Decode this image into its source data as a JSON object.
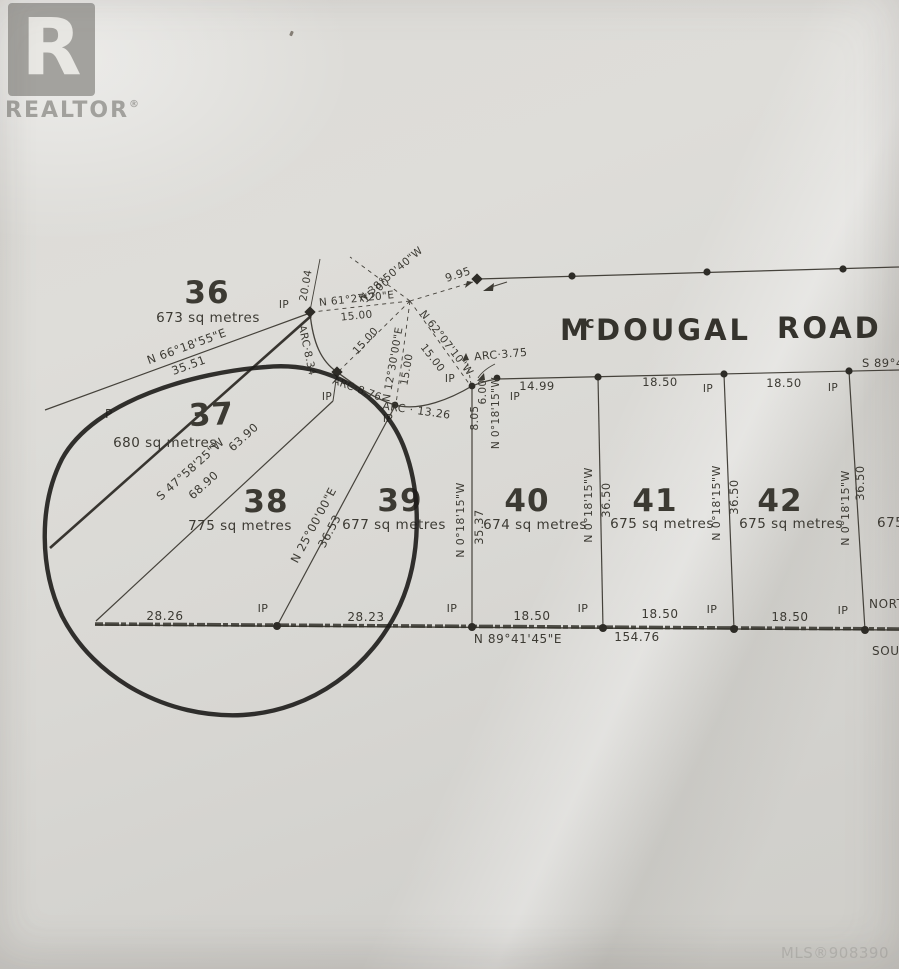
{
  "branding": {
    "logo_letter": "R",
    "logo_text": "REALTOR",
    "registered": "®"
  },
  "watermark": {
    "mls": "MLS®908390"
  },
  "road": {
    "m": "M",
    "c": "c",
    "dougal": "DOUGAL",
    "road_word": "ROAD"
  },
  "marks": {
    "ip": "IP",
    "post": "P"
  },
  "dims": {
    "d15": "15.00",
    "d1850": "18.50",
    "d1499": "14.99",
    "d2826": "28.26",
    "d2823": "28.23",
    "d3551": "35.51",
    "d3537": "35.37",
    "d3650": "36.50",
    "d3653": "36.53",
    "d6390": "63.90",
    "d6890": "68.90",
    "d995": "9.95",
    "d2004": "20.04",
    "d600": "6.00",
    "d805": "8.05",
    "d15476": "154.76"
  },
  "bearings": {
    "ns": "N 0°18'15\"W",
    "lot36_line": "N 66°18'55\"E",
    "lot37_line": "S 47°58'25\"W",
    "lot38_line": "N 25°00'00\"E",
    "south_line": "N 89°41'45\"E",
    "spoke_e": "N 61°27'20\"E",
    "spoke_nw": "N 38°50'40\"W",
    "spoke_mid": "N 12°30'00\"E",
    "spoke_se": "N 62°07'10\"W",
    "edge_clip": "S 89°4"
  },
  "arcs": {
    "a834": "ARC·8.34",
    "a876": "ARC·8.76",
    "a1326": "ARC · 13.26",
    "a375": "ARC·3.75"
  },
  "lots": {
    "l36": {
      "num": "36",
      "area": "673 sq metres"
    },
    "l37": {
      "num": "37",
      "area": "680 sq metres"
    },
    "l38": {
      "num": "38",
      "area": "775 sq metres"
    },
    "l39": {
      "num": "39",
      "area": "677 sq metres"
    },
    "l40": {
      "num": "40",
      "area": "674 sq metres"
    },
    "l41": {
      "num": "41",
      "area": "675 sq metres"
    },
    "l42": {
      "num": "42",
      "area": "675 sq metres"
    },
    "l43": {
      "area_partial": "675"
    }
  },
  "edge": {
    "north_clip": "NORT",
    "south_clip": "SOUT"
  }
}
